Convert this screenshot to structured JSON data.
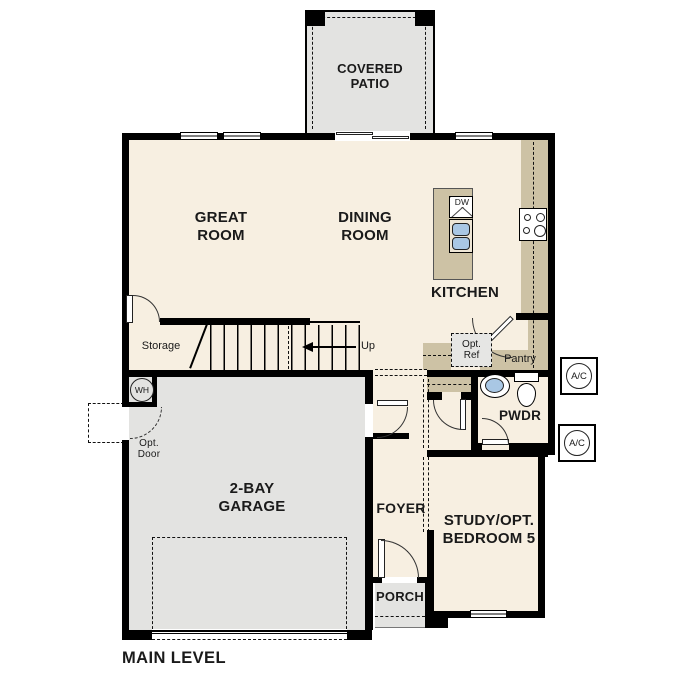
{
  "title": {
    "label": "MAIN LEVEL"
  },
  "rooms": {
    "covered_patio": "COVERED PATIO",
    "great_room": "GREAT ROOM",
    "dining_room": "DINING ROOM",
    "kitchen": "KITCHEN",
    "storage": "Storage",
    "pantry": "Pantry",
    "powder": "PWDR",
    "garage": "2-BAY GARAGE",
    "foyer": "FOYER",
    "study": "STUDY/OPT. BEDROOM 5",
    "porch": "PORCH"
  },
  "annotations": {
    "up": "Up",
    "opt_ref": "Opt. Ref",
    "opt_door": "Opt. Door"
  },
  "fixtures": {
    "dishwasher": "DW",
    "water_heater": "WH",
    "ac_unit": "A/C"
  },
  "colors": {
    "floor": "#f7efe1",
    "concrete": "#e3e3e1",
    "counter": "#cdc2a5",
    "water": "#a9c7e4",
    "wall": "#000000"
  }
}
